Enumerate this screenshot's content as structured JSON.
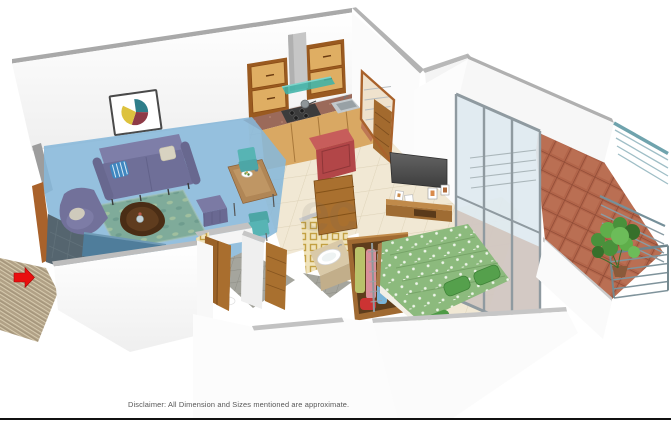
{
  "meta": {
    "description": "3D isometric cutaway floor plan render of a 1 BHK apartment",
    "background": "#ffffff"
  },
  "footer": {
    "disclaimer": "Disclaimer: All Dimension and Sizes mentioned are approximate."
  },
  "watermark": {
    "text": "ec",
    "opacity": 0.11
  },
  "entrance": {
    "indicator_icon": "red-arrow",
    "color": "#e90f0f",
    "direction": "right"
  },
  "highlight": {
    "room": "Living Room",
    "overlay_color": "#86b7da"
  },
  "rooms": [
    {
      "name": "Living Room",
      "highlighted": true,
      "furniture": [
        "purple-sofa",
        "purple-armchair",
        "coffee-table",
        "teal-rug",
        "purple-pouf",
        "tv-bench",
        "dining-table",
        "teal-dining-chairs",
        "wall-art",
        "entrance-door"
      ]
    },
    {
      "name": "Kitchen",
      "furniture": [
        "wall-cabinets",
        "chimney-hood",
        "gas-stove",
        "steel-sink",
        "granite-countertop",
        "red-cabinet"
      ]
    },
    {
      "name": "Bathroom 1",
      "furniture": [
        "wooden-door",
        "toilet",
        "patterned-wall-tiles",
        "gray-floor-tiles"
      ]
    },
    {
      "name": "Bathroom 2",
      "furniture": [
        "wooden-door",
        "wash-basin-vanity",
        "patterned-wall-tiles"
      ]
    },
    {
      "name": "Bedroom",
      "furniture": [
        "double-bed-green-duvet",
        "open-wardrobe-with-clothes",
        "wall-tv",
        "tv-unit",
        "photo-frames",
        "bedroom-door"
      ]
    },
    {
      "name": "Balcony",
      "furniture": [
        "potted-plant",
        "steel-railing",
        "terracotta-floor-tiles",
        "sliding-glass-door"
      ]
    }
  ],
  "palette": {
    "living_overlay": "#86b7da",
    "arrow_red": "#e90f0f",
    "sofa_purple": "#6f6f98",
    "duvet_green": "#8cba7d",
    "balcony_tile": "#b2654a",
    "cabinet_wood": "#dfae63",
    "door_wood": "#a9702f",
    "railing_steel": "#7f939b",
    "tv_gray": "#4a4a4a",
    "wall_white": "#fbfbfb",
    "wall_cap_gray": "#b3b3b3",
    "disclaimer_text": "#565656"
  }
}
